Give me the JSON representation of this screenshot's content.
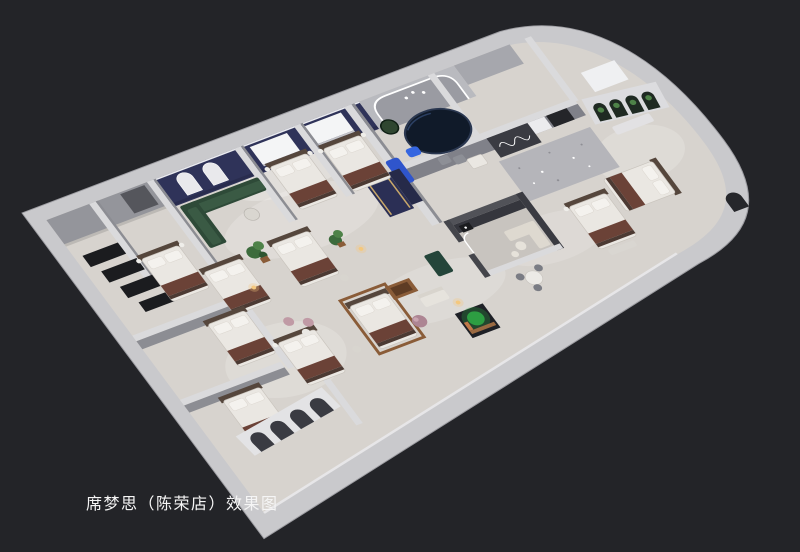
{
  "canvas": {
    "width": 800,
    "height": 552
  },
  "caption": {
    "text": "席梦思（陈荣店）效果图"
  },
  "palette": {
    "bg": "#232428",
    "caption": "#f5f5f5",
    "wallTop": "#c9c9cc",
    "wallTopLight": "#dadadc",
    "wallShade": "#8c8d93",
    "wallFaceGray": "#94959b",
    "floor": "#d7d3ce",
    "floorDark": "#c8c4bf",
    "navy": "#2f3359",
    "navyDark": "#262a49",
    "navyPanel": "#2b2f55",
    "ovalBed": "#101a29",
    "blue": "#2f55cc",
    "blueLight": "#3566e0",
    "greenSofa": "#2e4a38",
    "greenSofaLight": "#3a5a44",
    "plant": "#3c6b3c",
    "plantLight": "#4e8248",
    "plantBright": "#2fae45",
    "wood": "#8a5c38",
    "runner": "#6b4237",
    "runnerDark": "#4c3a33",
    "headboard": "#55463c",
    "mattress": "#eae7e2",
    "pillow": "#f4f2ee",
    "window": "#f4f5f6",
    "led": "#ffffff",
    "terrazzo": "#b5b5ba",
    "darkWall": "#3a3b42",
    "nearBlack": "#1b1c1f",
    "doorway": "#242529",
    "mauve": "#ad8593",
    "pinkChair": "#c09aa5",
    "gold": "#c9a86a",
    "lampGlow": "#f4c87e",
    "cream": "#ded9d0"
  }
}
